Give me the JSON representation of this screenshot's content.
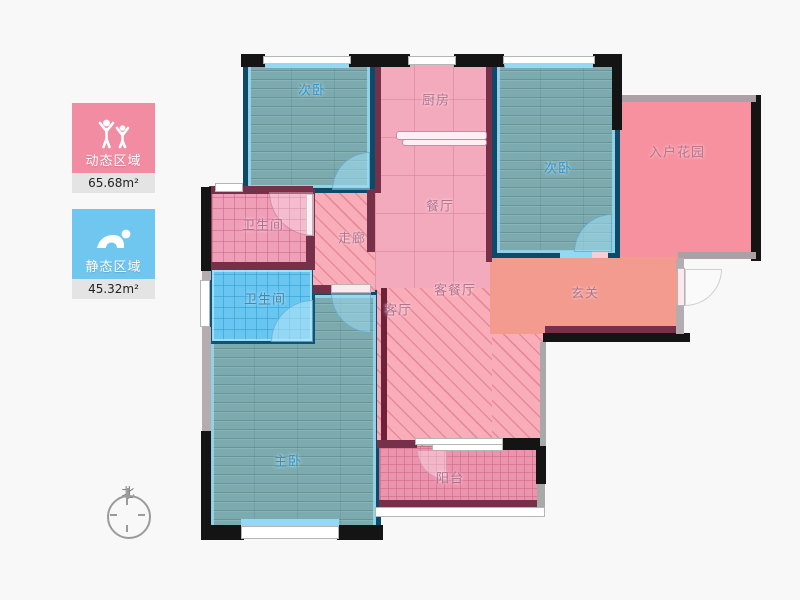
{
  "legend": {
    "dynamic": {
      "label": "动态区域",
      "area": "65.68m²",
      "color": "#f28ca3",
      "icon": "people-active-icon"
    },
    "static": {
      "label": "静态区域",
      "area": "45.32m²",
      "color": "#6fc6ef",
      "icon": "person-sleeping-icon"
    }
  },
  "compass": {
    "north_label": "北"
  },
  "rooms": {
    "bedroom_top_left": {
      "label": "次卧"
    },
    "kitchen": {
      "label": "厨房"
    },
    "dining": {
      "label": "餐厅"
    },
    "bedroom_top_right": {
      "label": "次卧"
    },
    "entry_garden": {
      "label": "入户花园"
    },
    "bathroom_upper": {
      "label": "卫生间"
    },
    "corridor": {
      "label": "走廊"
    },
    "living_dining": {
      "label": "客餐厅"
    },
    "foyer": {
      "label": "玄关"
    },
    "bathroom_lower": {
      "label": "卫生间"
    },
    "living": {
      "label": "客厅"
    },
    "master_bedroom": {
      "label": "主卧"
    },
    "balcony": {
      "label": "阳台"
    }
  },
  "colors": {
    "background": "#f8f8f8",
    "outer_wall": "#141414",
    "pink_wall": "#76304a",
    "blue_wall": "#0d4a68",
    "pink_floor": "#f3aabc",
    "foyer_salmon": "#f29b8e",
    "garden_pink": "#f7919f",
    "wood_teal": "#7cabaf",
    "bath_blue": "#69c6f0",
    "dynamic_badge": "#f28ca3",
    "static_badge": "#6fc6ef"
  }
}
